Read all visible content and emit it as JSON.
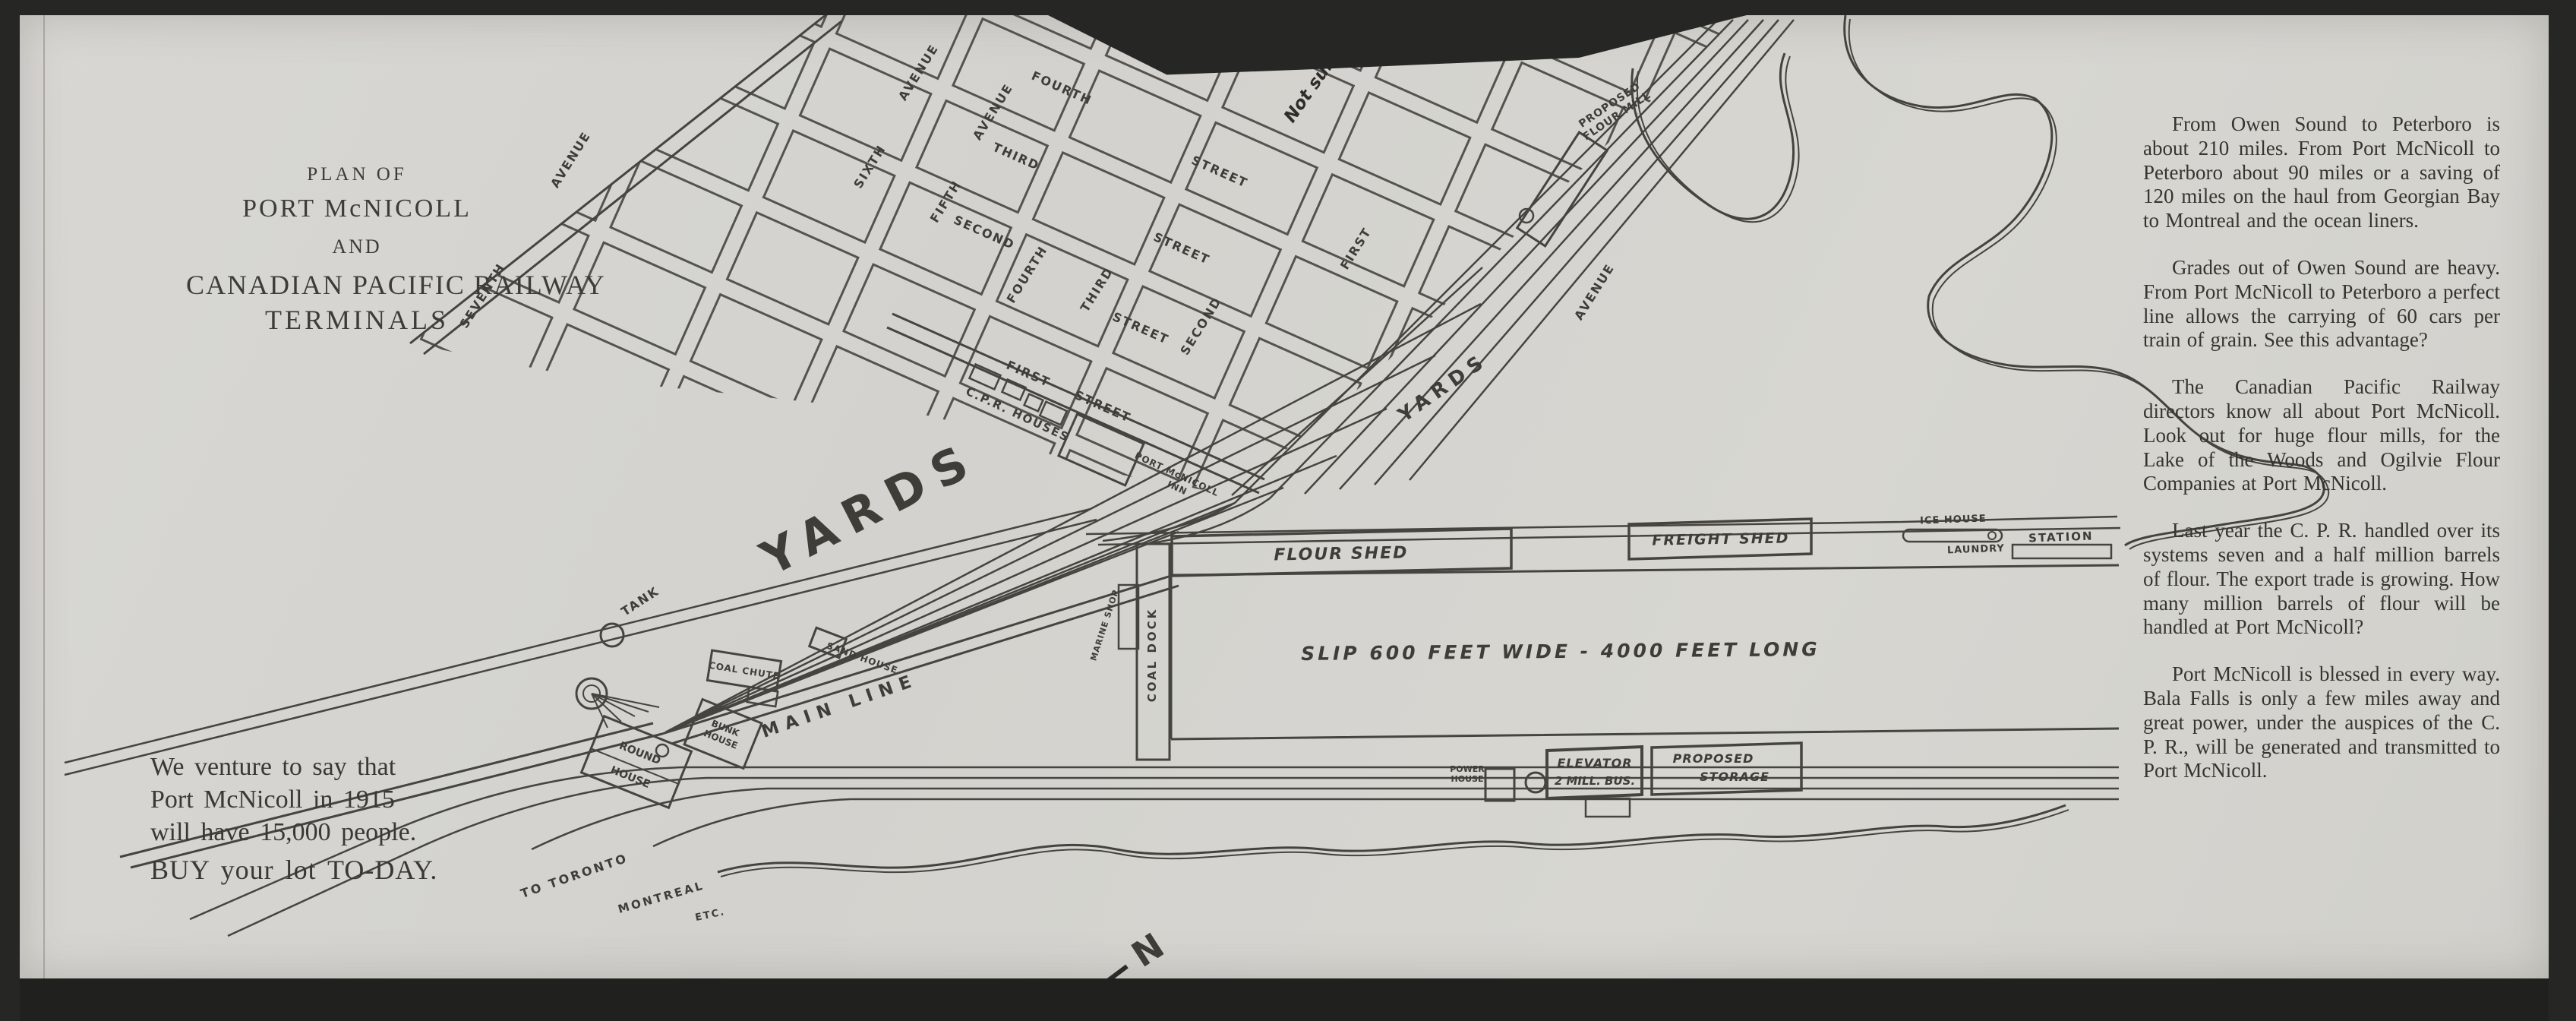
{
  "document": {
    "title": {
      "l1": "PLAN OF",
      "l2": "PORT McNICOLL",
      "l3": "AND",
      "l4": "CANADIAN PACIFIC RAILWAY",
      "l5": "TERMINALS"
    },
    "promo": {
      "l1": "We venture to say that",
      "l2": "Port McNicoll in 1915",
      "l3": "will have 15,000 people.",
      "l4": "BUY your lot TO-DAY."
    },
    "article": {
      "paragraphs": [
        "From Owen Sound to Peterboro is about 210 miles.  From Port McNicoll to Peterboro about 90 miles or a saving of 120 miles on the haul from Georgian Bay to Montreal and the ocean liners.",
        "Grades out of Owen Sound are heavy.  From Port McNicoll to Peterboro a perfect line allows the carrying of 60 cars per train of grain.  See this advantage?",
        "The Canadian Pacific Railway directors know all about Port McNicoll. Look out for huge flour mills, for the Lake of the Woods and Ogilvie Flour Companies at Port McNicoll.",
        "Last year the C. P. R. handled over its systems seven and a half million barrels of flour.  The export trade is growing.  How many million barrels of flour will be handled at Port McNicoll?",
        "Port McNicoll is blessed in every way.  Bala Falls is only a few miles away and great power, under the auspices of the C. P. R., will be generated and transmitted to Port McNicoll."
      ]
    }
  },
  "map": {
    "north": "N",
    "handwriting": {
      "not_surveyed": "Not surveyed"
    },
    "yards_large": "YARDS",
    "yards_small": "YARDS",
    "labels": {
      "tank": "TANK",
      "main_line": "MAIN LINE",
      "coal_chute": "COAL CHUTE",
      "sand_house": "SAND HOUSE",
      "round_house_1": "ROUND",
      "round_house_2": "HOUSE",
      "bunk_house_1": "BUNK",
      "bunk_house_2": "HOUSE",
      "cpr_houses": "C.P.R. HOUSES",
      "inn_1": "PORT McNICOLL",
      "inn_2": "INN",
      "mill_1": "PROPOSED",
      "mill_2": "FLOUR MILL",
      "flour_shed": "FLOUR SHED",
      "freight_shed": "FREIGHT SHED",
      "ice_house": "ICE HOUSE",
      "laundry": "LAUNDRY",
      "station": "STATION",
      "slip": "SLIP  600  FEET  WIDE - 4000 FEET LONG",
      "coal_dock": "COAL DOCK",
      "marine_shop": "MARINE SHOP",
      "power_house_1": "POWER",
      "power_house_2": "HOUSE",
      "elevator_1": "ELEVATOR",
      "elevator_2": "2 MILL. BUS.",
      "storage_1": "PROPOSED",
      "storage_2": "STORAGE",
      "to_toronto": "TO TORONTO",
      "montreal": "MONTREAL",
      "etc": "ETC."
    },
    "grid_labels": [
      {
        "t": "SEVENTH"
      },
      {
        "t": "AVENUE"
      },
      {
        "t": "SIXTH"
      },
      {
        "t": "AVENUE"
      },
      {
        "t": "FIFTH"
      },
      {
        "t": "AVENUE"
      },
      {
        "t": "FOURTH"
      },
      {
        "t": "THIRD"
      },
      {
        "t": "SECOND"
      },
      {
        "t": "STREET"
      },
      {
        "t": "STREET"
      },
      {
        "t": "FOURTH"
      },
      {
        "t": "THIRD"
      },
      {
        "t": "SECOND"
      },
      {
        "t": "STREET"
      },
      {
        "t": "FIRST"
      },
      {
        "t": "AVENUE"
      },
      {
        "t": "FIRST"
      },
      {
        "t": "STREET"
      }
    ]
  }
}
